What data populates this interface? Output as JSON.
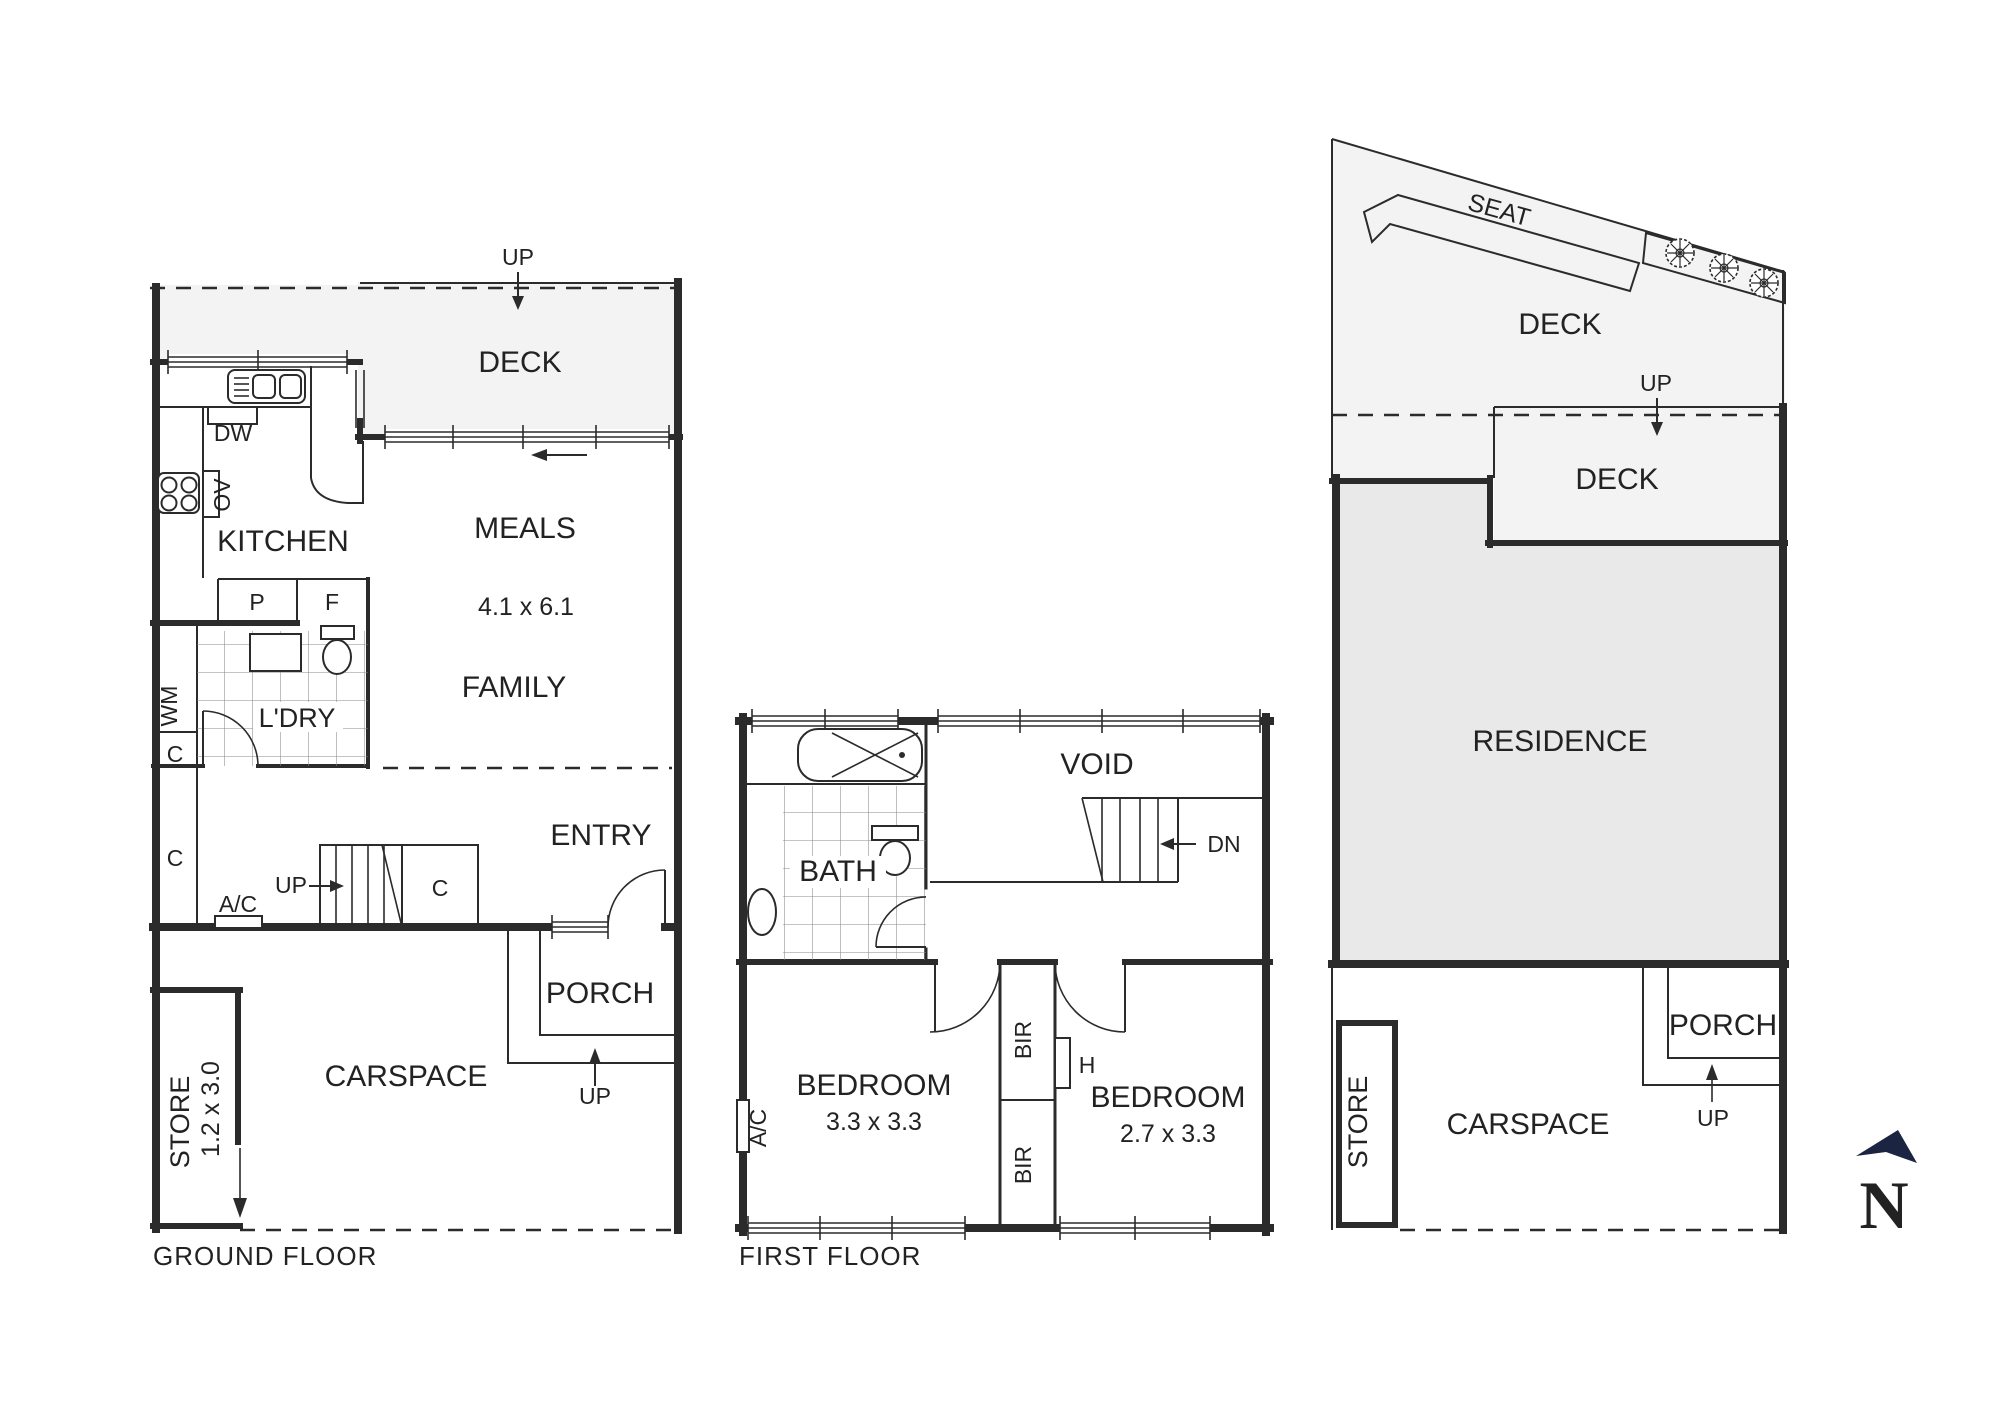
{
  "colors": {
    "wall": "#2b2b2b",
    "deck_fill": "#f3f3f3",
    "residence_fill": "#eae9e9",
    "planter_fill": "#e9e9e9",
    "north": "#1b2440",
    "text": "#222222"
  },
  "ground": {
    "title": "GROUND FLOOR",
    "deck": "DECK",
    "deck_up": "UP",
    "kitchen": "KITCHEN",
    "dishwasher": "DW",
    "oven": "OV",
    "meals": "MEALS",
    "meals_dim": "4.1 x 6.1",
    "family": "FAMILY",
    "pantry": "P",
    "fridge": "F",
    "laundry": "L'DRY",
    "washer": "WM",
    "cupboard_small": "C",
    "cupboard_tall": "C",
    "aircon": "A/C",
    "stairs_up": "UP",
    "cupboard_stairs": "C",
    "entry": "ENTRY",
    "porch": "PORCH",
    "porch_up": "UP",
    "carspace": "CARSPACE",
    "store": "STORE",
    "store_dim": "1.2 x 3.0"
  },
  "first": {
    "title": "FIRST FLOOR",
    "bath": "BATH",
    "void": "VOID",
    "stairs_dn": "DN",
    "bedroom1": "BEDROOM",
    "bedroom1_dim": "3.3 x 3.3",
    "bir_top": "BIR",
    "heater": "H",
    "bir_bottom": "BIR",
    "bedroom2": "BEDROOM",
    "bedroom2_dim": "2.7 x 3.3",
    "aircon": "A/C"
  },
  "site": {
    "seat": "SEAT",
    "deck_upper": "DECK",
    "deck_up": "UP",
    "deck_mid": "DECK",
    "residence": "RESIDENCE",
    "porch": "PORCH",
    "porch_up": "UP",
    "store": "STORE",
    "carspace": "CARSPACE"
  },
  "compass": {
    "north": "N"
  }
}
